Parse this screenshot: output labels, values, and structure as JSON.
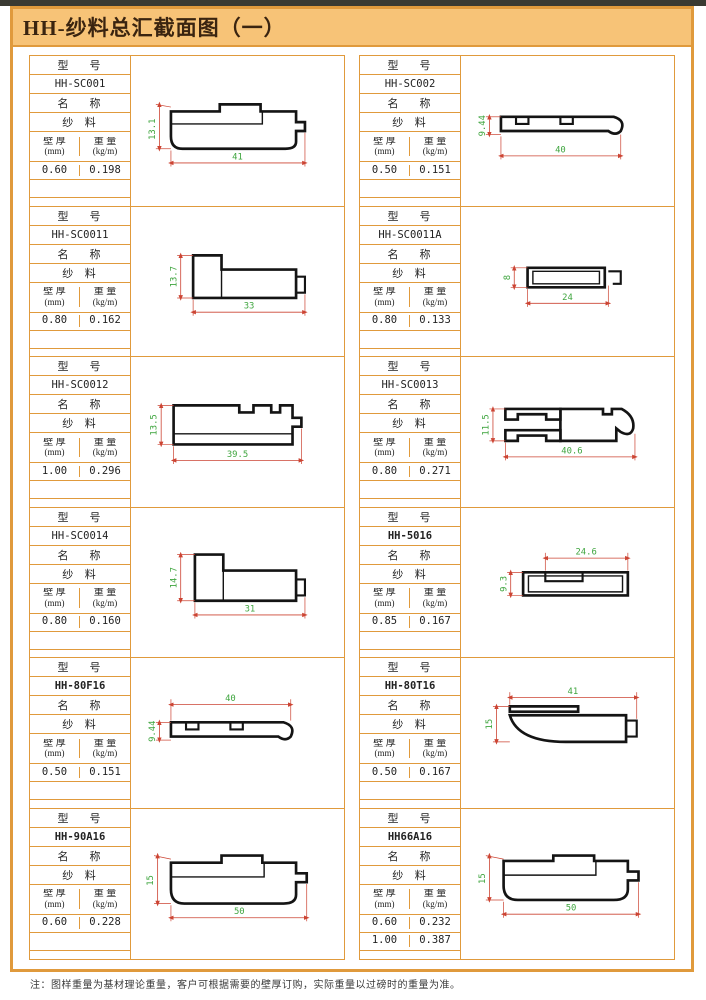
{
  "page": {
    "title": "HH-纱料总汇截面图（一）",
    "footnote": "注：图样重量为基材理论重量，客户可根据需要的壁厚订购，实际重量以过磅时的重量为准。"
  },
  "colors": {
    "frame_orange": "#E09A3C",
    "title_background": "#F7C377",
    "dimension_line_red": "#CC4433",
    "dimension_text_green": "#3FA53F",
    "profile_black": "#141414"
  },
  "labels": {
    "model": "型    号",
    "name": "名    称",
    "th1": "壁 厚",
    "th2": "(mm)",
    "wt1": "重 量",
    "wt2": "(kg/m)"
  },
  "cells": [
    {
      "model": "HH-SC001",
      "name": "纱  料",
      "bold": false,
      "rows": [
        {
          "t": "0.60",
          "w": "0.198"
        }
      ],
      "dims": {
        "h": "13.1",
        "w": "41"
      }
    },
    {
      "model": "HH-SC002",
      "name": "纱  料",
      "bold": false,
      "rows": [
        {
          "t": "0.50",
          "w": "0.151"
        }
      ],
      "dims": {
        "h": "9.44",
        "w": "40"
      }
    },
    {
      "model": "HH-SC0011",
      "name": "纱  料",
      "bold": false,
      "rows": [
        {
          "t": "0.80",
          "w": "0.162"
        }
      ],
      "dims": {
        "h": "13.7",
        "w": "33"
      }
    },
    {
      "model": "HH-SC0011A",
      "name": "纱  料",
      "bold": false,
      "rows": [
        {
          "t": "0.80",
          "w": "0.133"
        }
      ],
      "dims": {
        "h": "8",
        "w": "24"
      }
    },
    {
      "model": "HH-SC0012",
      "name": "纱  料",
      "bold": false,
      "rows": [
        {
          "t": "1.00",
          "w": "0.296"
        }
      ],
      "dims": {
        "h": "13.5",
        "w": "39.5"
      }
    },
    {
      "model": "HH-SC0013",
      "name": "纱  料",
      "bold": false,
      "rows": [
        {
          "t": "0.80",
          "w": "0.271"
        }
      ],
      "dims": {
        "h": "11.5",
        "w": "40.6"
      }
    },
    {
      "model": "HH-SC0014",
      "name": "纱  料",
      "bold": false,
      "rows": [
        {
          "t": "0.80",
          "w": "0.160"
        }
      ],
      "dims": {
        "h": "14.7",
        "w": "31"
      }
    },
    {
      "model": "HH-5016",
      "name": "纱  料",
      "bold": true,
      "rows": [
        {
          "t": "0.85",
          "w": "0.167"
        }
      ],
      "dims": {
        "h": "9.3",
        "w": "24.6"
      }
    },
    {
      "model": "HH-80F16",
      "name": "纱  料",
      "bold": true,
      "rows": [
        {
          "t": "0.50",
          "w": "0.151"
        }
      ],
      "dims": {
        "h": "9.44",
        "w": "40"
      }
    },
    {
      "model": "HH-80T16",
      "name": "纱  料",
      "bold": true,
      "rows": [
        {
          "t": "0.50",
          "w": "0.167"
        }
      ],
      "dims": {
        "h": "15",
        "w": "41"
      }
    },
    {
      "model": "HH-90A16",
      "name": "纱  料",
      "bold": true,
      "rows": [
        {
          "t": "0.60",
          "w": "0.228"
        }
      ],
      "dims": {
        "h": "15",
        "w": "50"
      }
    },
    {
      "model": "HH66A16",
      "name": "纱  料",
      "bold": true,
      "rows": [
        {
          "t": "0.60",
          "w": "0.232"
        },
        {
          "t": "1.00",
          "w": "0.387"
        }
      ],
      "dims": {
        "h": "15",
        "w": "50"
      }
    }
  ]
}
